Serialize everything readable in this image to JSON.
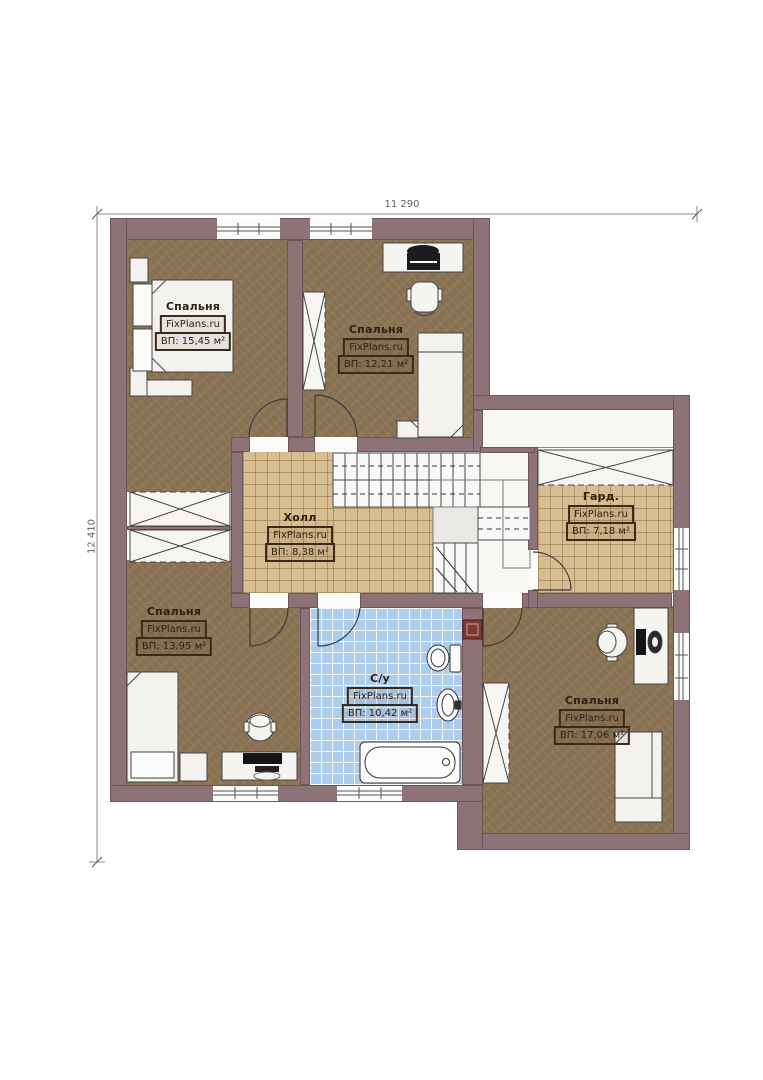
{
  "plan": {
    "dimensions": {
      "width_label": "11 290",
      "height_label": "12 410"
    },
    "brand": "FixPlans.ru",
    "rooms": [
      {
        "id": "bedroom-top-left",
        "name": "Спальня",
        "brand": "FixPlans.ru",
        "area": "ВП: 15,45 м²"
      },
      {
        "id": "bedroom-top-middle",
        "name": "Спальня",
        "brand": "FixPlans.ru",
        "area": "ВП: 12,21 м²"
      },
      {
        "id": "hall",
        "name": "Холл",
        "brand": "FixPlans.ru",
        "area": "ВП: 8,38 м²"
      },
      {
        "id": "wardrobe",
        "name": "Гард.",
        "brand": "FixPlans.ru",
        "area": "ВП: 7,18 м²"
      },
      {
        "id": "bedroom-bottom-left",
        "name": "Спальня",
        "brand": "FixPlans.ru",
        "area": "ВП: 13,95 м²"
      },
      {
        "id": "bathroom",
        "name": "С/у",
        "brand": "FixPlans.ru",
        "area": "ВП: 10,42 м²"
      },
      {
        "id": "bedroom-bottom-right",
        "name": "Спальня",
        "brand": "FixPlans.ru",
        "area": "ВП: 17,06 м²"
      }
    ],
    "colors": {
      "wall": "#8d7277",
      "wood_floor": "#8b7355",
      "tile_beige": "#d9bd92",
      "tile_blue": "#aecdec",
      "vent_accent": "#7d3a33"
    }
  }
}
